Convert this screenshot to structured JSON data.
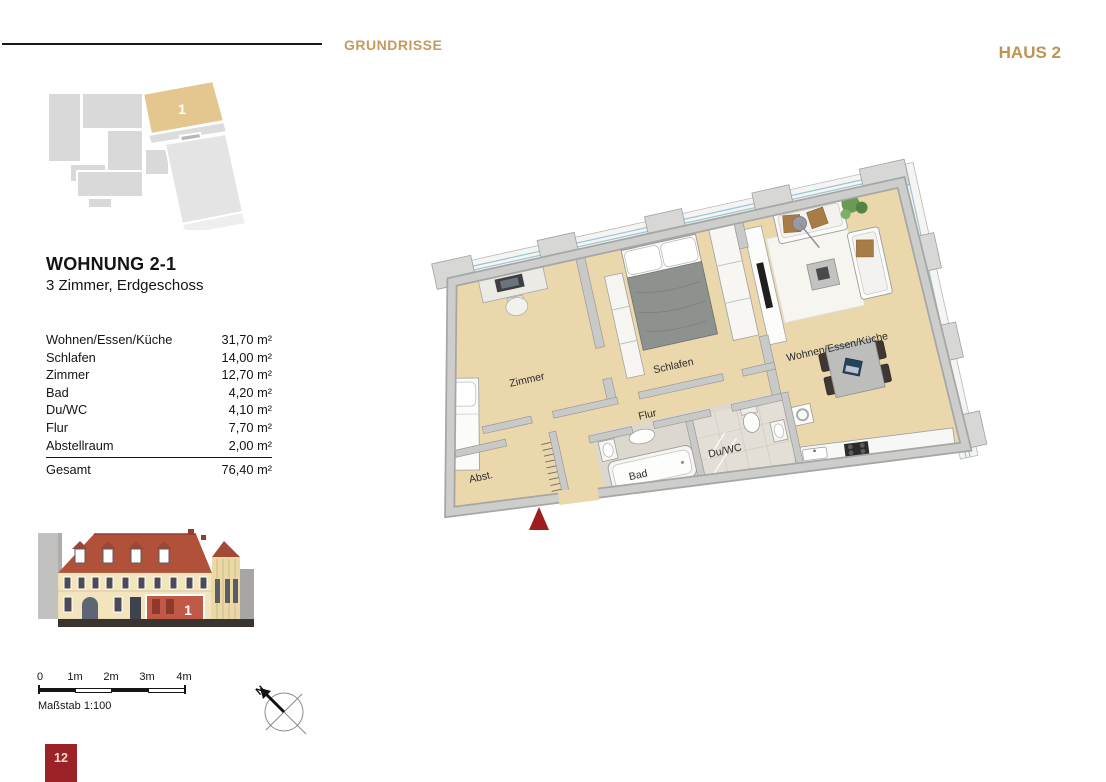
{
  "header": {
    "section_title": "GRUNDRISSE",
    "building_label": "HAUS 2"
  },
  "overview_map": {
    "unit_number": "1"
  },
  "apartment": {
    "name": "WOHNUNG 2-1",
    "description": "3 Zimmer, Erdgeschoss"
  },
  "area_table": {
    "rows": [
      {
        "label": "Wohnen/Essen/Küche",
        "value": "31,70 m²"
      },
      {
        "label": "Schlafen",
        "value": "14,00 m²"
      },
      {
        "label": "Zimmer",
        "value": "12,70 m²"
      },
      {
        "label": "Bad",
        "value": "4,20 m²"
      },
      {
        "label": "Du/WC",
        "value": "4,10 m²"
      },
      {
        "label": "Flur",
        "value": "7,70 m²"
      },
      {
        "label": "Abstellraum",
        "value": "2,00 m²"
      }
    ],
    "total_label": "Gesamt",
    "total_value": "76,40 m²"
  },
  "elevation": {
    "unit_number": "1"
  },
  "floor_plan": {
    "labels": {
      "zimmer": "Zimmer",
      "schlafen": "Schlafen",
      "flur": "Flur",
      "abstellraum": "Abst.",
      "bad": "Bad",
      "du_wc": "Du/WC",
      "wohnen_essen_kueche": "Wohnen/Essen/Küche"
    }
  },
  "scale_bar": {
    "ticks": [
      "0",
      "1m",
      "2m",
      "3m",
      "4m"
    ],
    "caption": "Maßstab 1:100"
  },
  "compass": {
    "north_label": "N"
  },
  "page": {
    "number": "12"
  },
  "colors": {
    "accent_gold": "#c49a5e",
    "brand_red": "#9b2227",
    "plan_floor": "#ead7ab",
    "map_highlight": "#e4c78e"
  }
}
